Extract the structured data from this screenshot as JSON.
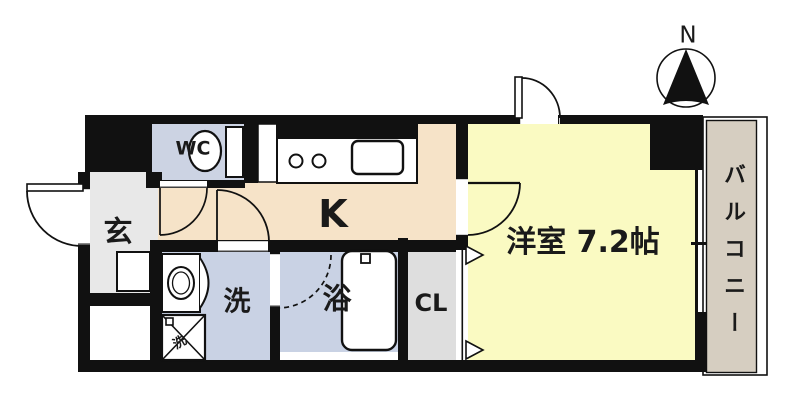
{
  "compass": {
    "north_label": "N"
  },
  "rooms": {
    "wc": {
      "label": "WC"
    },
    "kitchen": {
      "label": "K"
    },
    "entrance": {
      "label": "玄"
    },
    "washroom": {
      "label": "洗"
    },
    "bathroom": {
      "label": "浴"
    },
    "closet": {
      "label": "CL"
    },
    "western_room": {
      "label": "洋室 7.2帖"
    },
    "balcony": {
      "label": "バルコニー"
    }
  },
  "fixtures": {
    "washing_machine_label": "洗"
  },
  "colors": {
    "wall": "#111111",
    "kitchen_floor": "#f6e3c8",
    "room_floor": "#fafac2",
    "wet_floor": "#c9d2e4",
    "wc_floor": "#ccd3e3",
    "entrance_floor": "#e8e8e8",
    "closet_floor": "#dedede",
    "balcony_floor": "#d6cec1",
    "background": "#ffffff"
  }
}
